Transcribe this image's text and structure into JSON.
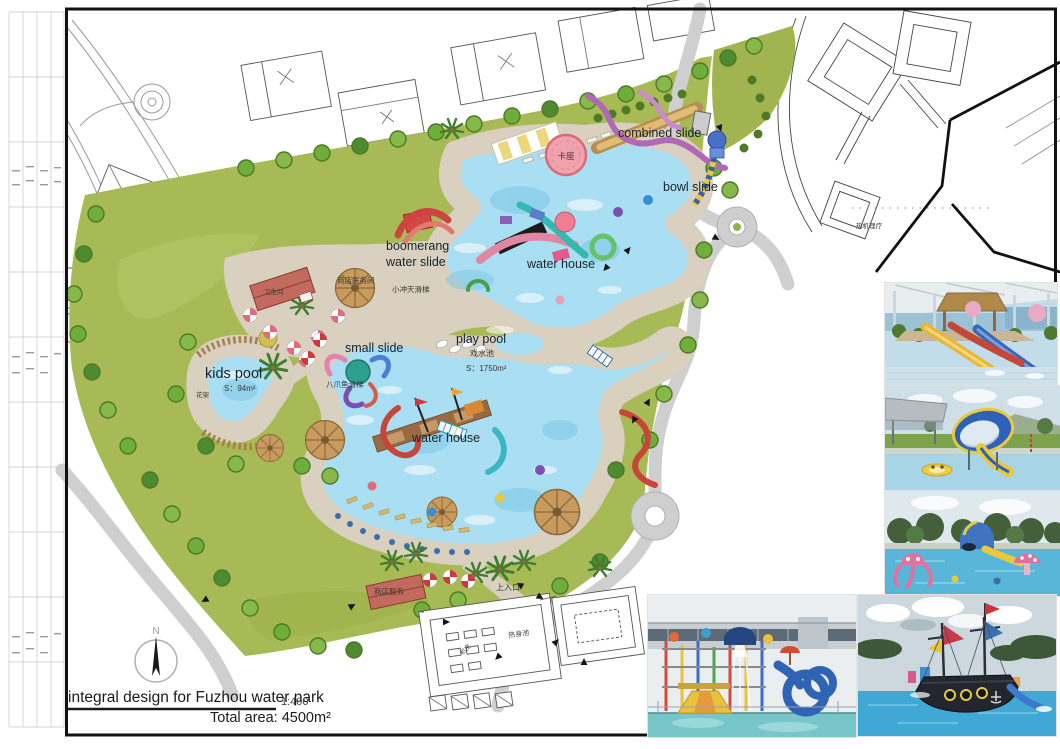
{
  "plan": {
    "labels": {
      "combined_slide": "combined slide",
      "bowl_slide": "bowl slide",
      "boomerang_line1": "boomerang",
      "boomerang_line2": "water slide",
      "water_house_upper": "water house",
      "play_pool": "play pool",
      "play_pool_area": "S：1750m²",
      "small_slide": "small slide",
      "kids_pool": "kids pool",
      "kids_pool_area": "S：94m²",
      "water_house_lower": "water house"
    },
    "labels_cn": {
      "card_seating": "卡座",
      "restroom": "卫生间",
      "shop_medical_room": "商店医务间",
      "small_sky_slide": "小冲天滑梯",
      "octopus_slide": "八爪鱼滑梯",
      "paddling_pool": "戏水池",
      "pergola": "花架",
      "shop_service": "商店服务",
      "upper_entrance": "上入口",
      "warm_up_pool": "热身池",
      "machine_room": "机房",
      "thermal_therapy": "热机理疗"
    }
  },
  "title_block": {
    "project_title": "integral design for Fuzhou water park",
    "scale": "1:400",
    "total_area": "Total area: 4500m²",
    "compass_north": "N"
  },
  "colors": {
    "pool_water": "#aadef2",
    "parkland_green": "#a8ba55",
    "path_tan": "#d9d0bf",
    "road_gray": "#cfcfcf",
    "accent_pink": "#f0a2ae"
  }
}
